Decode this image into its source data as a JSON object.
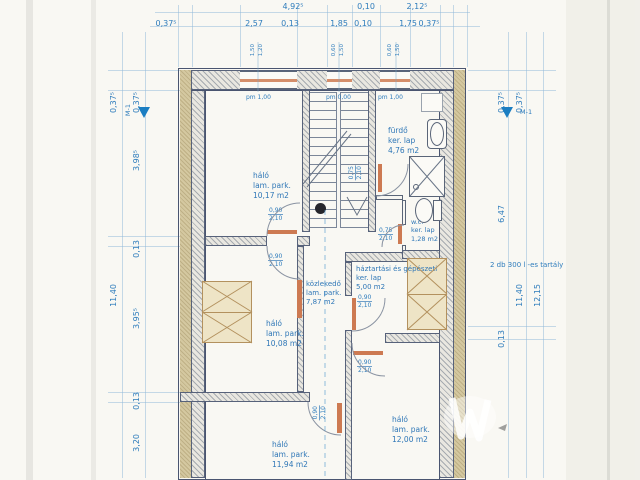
{
  "drawing_type": "architectural floor plan (scanned)",
  "markers": {
    "section": "M-1"
  },
  "annotation_tank": "2 db 300 l -es tartály",
  "dims": {
    "top1": [
      "4,92⁵",
      "0,10",
      "2,12⁵"
    ],
    "top2": [
      "0,37⁵",
      "2,57",
      "0,13",
      "1,85",
      "0,10",
      "1,75",
      "0,37⁵"
    ],
    "left_outer": [
      "0,37⁵",
      "11,40"
    ],
    "left_inner": [
      "0,37⁵",
      "3,98⁵",
      "0,13",
      "3,95⁵",
      "0,13",
      "3,20"
    ],
    "right_inner": [
      "0,37⁵",
      "6,47",
      "0,13"
    ],
    "right_mid": [
      "0,37⁵",
      "11,40"
    ],
    "right_outer": "12,15"
  },
  "windows": [
    {
      "size_top": "1,50",
      "size_bottom": "1,20",
      "sill": "pm 1,00"
    },
    {
      "size_top": "0,60",
      "size_bottom": "1,50",
      "sill": "pm 0,00"
    },
    {
      "size_top": "0,60",
      "size_bottom": "1,50",
      "sill": "pm 1,00"
    }
  ],
  "rooms": [
    {
      "name": "háló",
      "floor": "lam. park.",
      "area": "10,17 m2"
    },
    {
      "name": "fürdő",
      "floor": "ker. lap",
      "area": "4,76 m2"
    },
    {
      "name": "w.c.",
      "floor": "ker. lap",
      "area": "1,28 m2"
    },
    {
      "name": "háztartási és gépészeti",
      "floor": "ker. lap",
      "area": "5,00 m2"
    },
    {
      "name": "közlekedő",
      "floor": "lam. park.",
      "area": "7,87 m2"
    },
    {
      "name": "háló",
      "floor": "lam. park.",
      "area": "10,08 m2"
    },
    {
      "name": "háló",
      "floor": "lam. park.",
      "area": "11,94 m2"
    },
    {
      "name": "háló",
      "floor": "lam. park.",
      "area": "12,00 m2"
    }
  ],
  "doors": [
    {
      "width": "0,90",
      "height": "2,10"
    },
    {
      "width": "0,90",
      "height": "2,10"
    },
    {
      "width": "0,90",
      "height": "2,10"
    },
    {
      "width": "0,90",
      "height": "2,10"
    },
    {
      "width": "0,90",
      "height": "2,10"
    },
    {
      "width": "0,75",
      "height": "2,10"
    },
    {
      "width": "0,75",
      "height": "2,10"
    }
  ],
  "colors": {
    "dimension_text": "#2e7cbc",
    "wall_line": "#4a5570",
    "insulation_tan": "#d4c8a0",
    "accent_orange": "#cd7a52",
    "section_marker_blue": "#1b7ec2",
    "paper": "#f9f8f3"
  }
}
